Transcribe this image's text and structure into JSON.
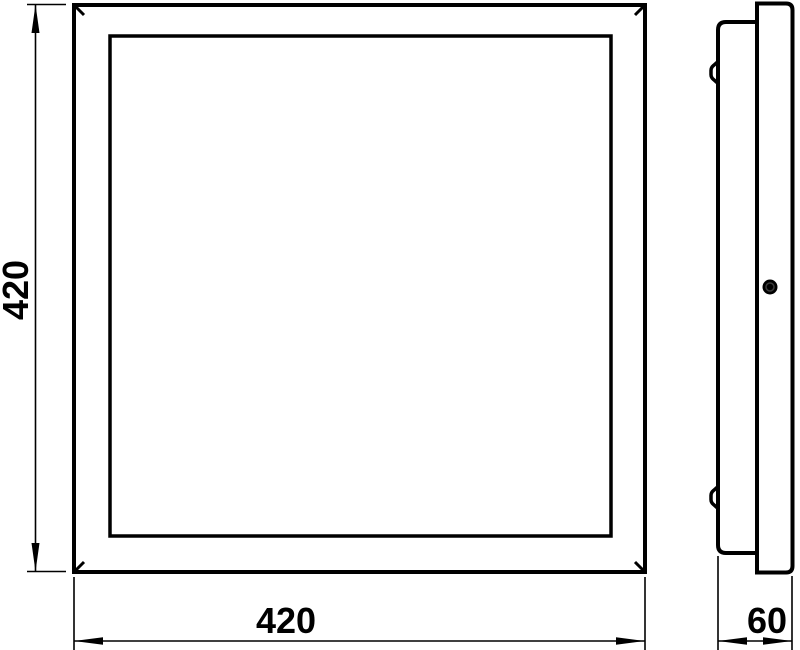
{
  "canvas": {
    "background_color": "#ffffff",
    "line_color": "#000000"
  },
  "drawing": {
    "type": "technical-dimension-drawing",
    "views": {
      "front": {
        "label": "front-view-square-panel"
      },
      "side": {
        "label": "side-profile-view"
      }
    }
  },
  "dims": {
    "front_height": "420",
    "front_width": "420",
    "side_depth": "60"
  }
}
